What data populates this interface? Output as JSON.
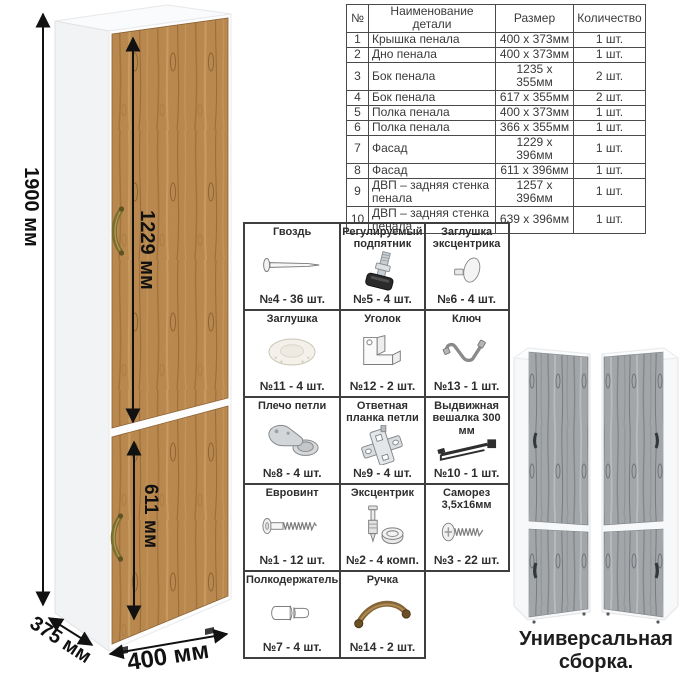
{
  "dimensions": {
    "height": "1900 мм",
    "upper_door": "1229 мм",
    "lower_door": "611 мм",
    "depth": "375 мм",
    "width": "400 мм"
  },
  "parts_table": {
    "headers": [
      "№",
      "Наименование детали",
      "Размер",
      "Количество"
    ],
    "rows": [
      [
        "1",
        "Крышка пенала",
        "400 х 373мм",
        "1 шт."
      ],
      [
        "2",
        "Дно пенала",
        "400 х 373мм",
        "1 шт."
      ],
      [
        "3",
        "Бок пенала",
        "1235 х 355мм",
        "2 шт."
      ],
      [
        "4",
        "Бок пенала",
        "617 х 355мм",
        "2 шт."
      ],
      [
        "5",
        "Полка пенала",
        "400 х 373мм",
        "1 шт."
      ],
      [
        "6",
        "Полка пенала",
        "366 х 355мм",
        "1 шт."
      ],
      [
        "7",
        "Фасад",
        "1229 х 396мм",
        "1 шт."
      ],
      [
        "8",
        "Фасад",
        "611 х 396мм",
        "1 шт."
      ],
      [
        "9",
        "ДВП – задняя стенка пенала",
        "1257 х 396мм",
        "1 шт."
      ],
      [
        "10",
        "ДВП – задняя стенка пенала",
        "639 х 396мм",
        "1 шт."
      ]
    ]
  },
  "hardware": {
    "cells": [
      {
        "name": "Гвоздь",
        "count": "№4 - 36 шт.",
        "icon": "nail-icon"
      },
      {
        "name": "Регулируемый подпятник",
        "count": "№5 - 4 шт.",
        "icon": "adjustable-foot-icon"
      },
      {
        "name": "Заглушка эксцентрика",
        "count": "№6 - 4 шт.",
        "icon": "cam-cover-icon"
      },
      {
        "name": "Заглушка",
        "count": "№11 - 4 шт.",
        "icon": "cover-cap-icon"
      },
      {
        "name": "Уголок",
        "count": "№12 - 2 шт.",
        "icon": "corner-bracket-icon"
      },
      {
        "name": "Ключ",
        "count": "№13 - 1 шт.",
        "icon": "hex-key-icon"
      },
      {
        "name": "Плечо петли",
        "count": "№8 - 4 шт.",
        "icon": "hinge-arm-icon"
      },
      {
        "name": "Ответная планка петли",
        "count": "№9 - 4 шт.",
        "icon": "hinge-plate-icon"
      },
      {
        "name": "Выдвижная вешалка 300 мм",
        "count": "№10 - 1 шт.",
        "icon": "pullout-hanger-icon"
      },
      {
        "name": "Евровинт",
        "count": "№1 - 12 шт.",
        "icon": "confirmat-screw-icon"
      },
      {
        "name": "Эксцентрик",
        "count": "№2 - 4 комп.",
        "icon": "cam-lock-icon"
      },
      {
        "name": "Саморез 3,5х16мм",
        "count": "№3 - 22 шт.",
        "icon": "self-tapping-screw-icon"
      },
      {
        "name": "Полкодержатель",
        "count": "№7 - 4 шт.",
        "icon": "shelf-pin-icon"
      },
      {
        "name": "Ручка",
        "count": "№14 - 2 шт.",
        "icon": "handle-icon"
      }
    ]
  },
  "footer": {
    "caption": "Универсальная сборка."
  },
  "colors": {
    "wood": "#b9884e",
    "wood_dark": "#9a6f3c",
    "gray_wood": "#a2a6a9",
    "gray_wood_dark": "#83878a",
    "handle_bronze": "#7c6c30",
    "line": "#111111",
    "table_border": "#4a4a4a"
  }
}
